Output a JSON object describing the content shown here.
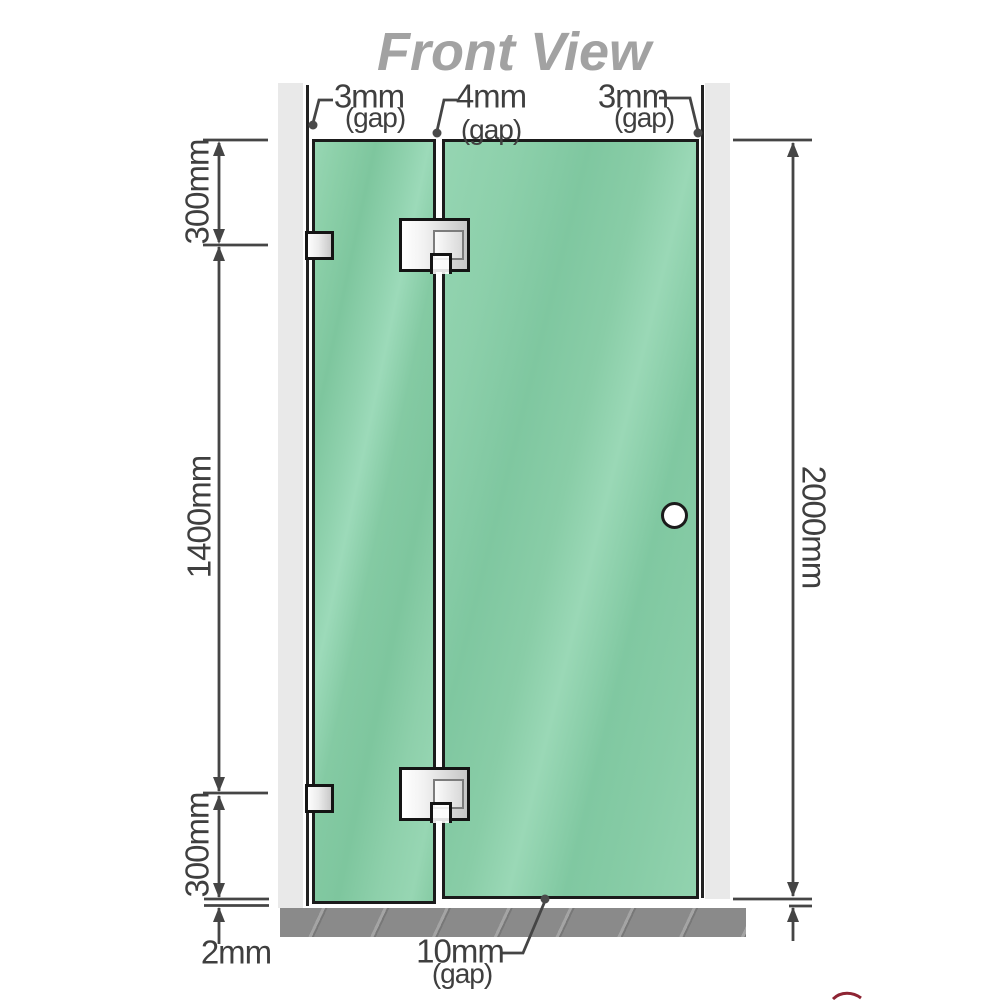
{
  "title": "Front View",
  "gap_labels": {
    "top_left": {
      "value": "3mm",
      "label": "(gap)"
    },
    "top_middle": {
      "value": "4mm",
      "label": "(gap)"
    },
    "top_right": {
      "value": "3mm",
      "label": "(gap)"
    },
    "bottom_middle": {
      "value": "10mm",
      "label": "(gap)"
    },
    "bottom_left": {
      "value": "2mm"
    }
  },
  "dimensions": {
    "left_top": "300mm",
    "left_middle": "1400mm",
    "left_bottom": "300mm",
    "right_overall": "2000mm"
  },
  "colors": {
    "glass_green": "#85cba6",
    "wall_gray": "#e9e9e9",
    "floor_gray": "#8a8a8a",
    "dimension_line": "#454545",
    "title_gray": "#a2a2a2",
    "hinge_silver": "#d9d9d9",
    "glass_border": "#1b1b1b"
  }
}
